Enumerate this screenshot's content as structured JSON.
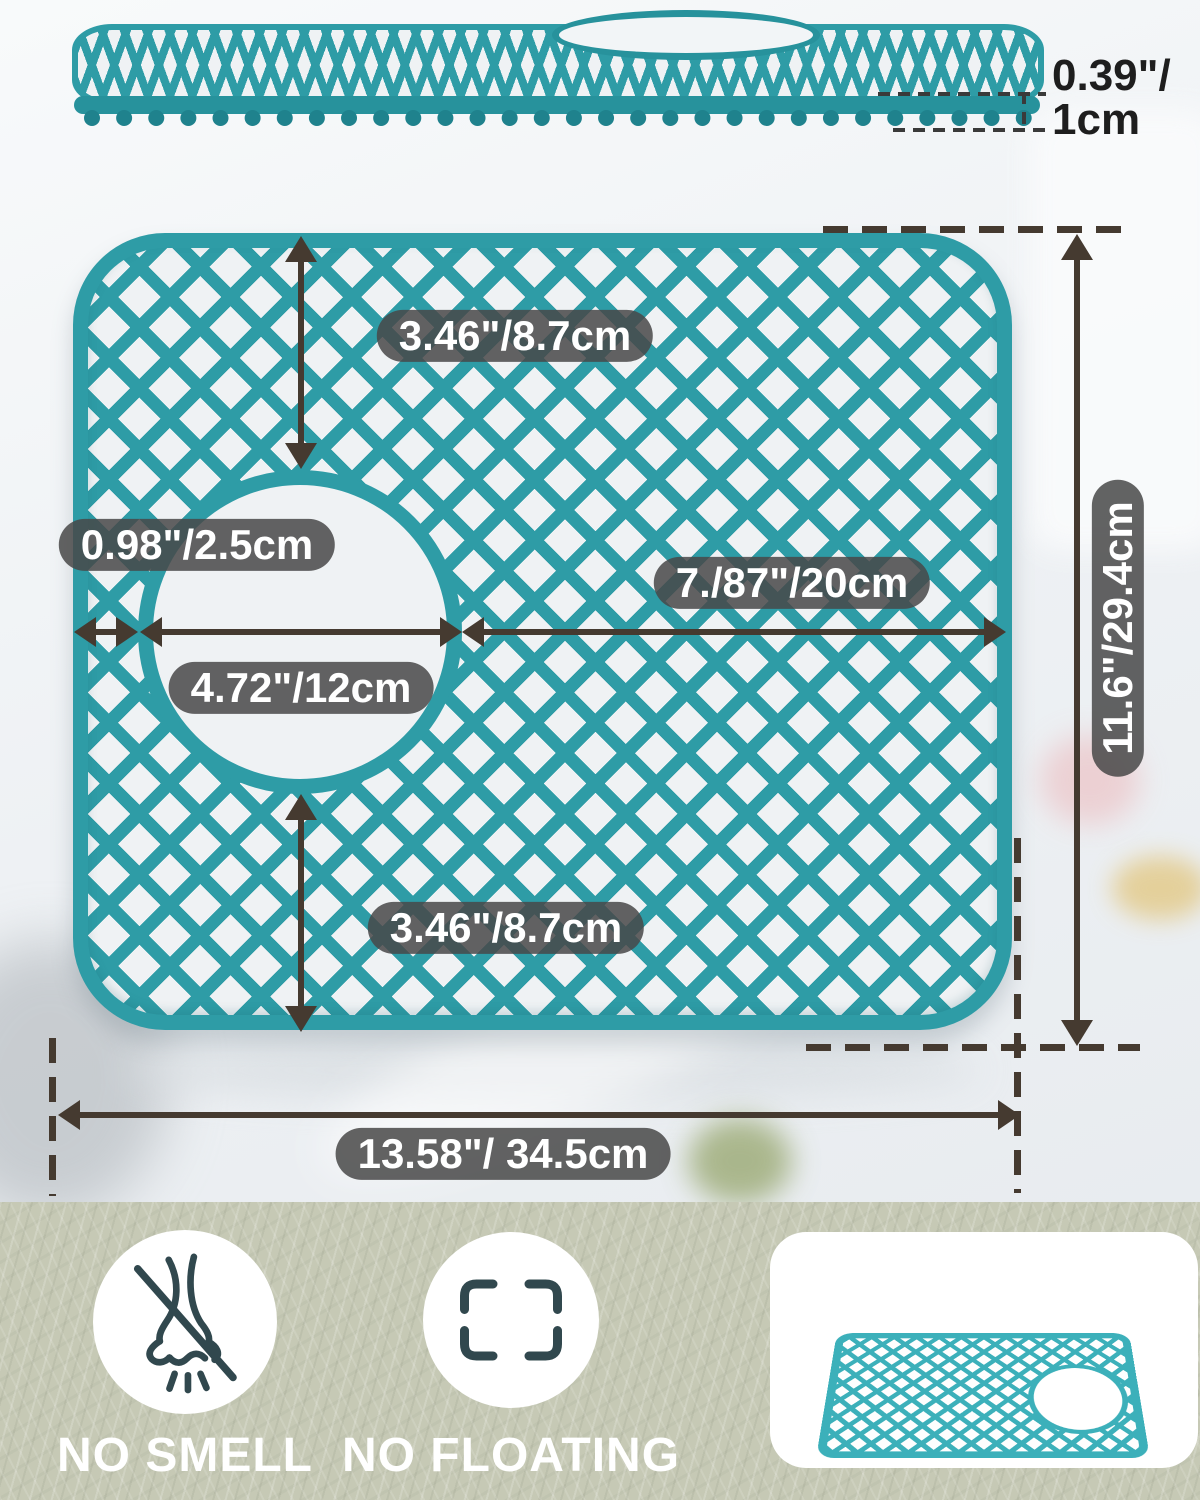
{
  "side_view": {
    "thickness_line1": "0.39\"/",
    "thickness_line2": "1cm"
  },
  "dimensions": {
    "top_gap": "3.46\"/8.7cm",
    "left_edge_gap": "0.98\"/2.5cm",
    "hole_diameter": "4.72\"/12cm",
    "right_span": "7./87\"/20cm",
    "mat_height": "11.6\"/29.4cm",
    "bottom_gap": "3.46\"/8.7cm",
    "mat_width": "13.58\"/ 34.5cm"
  },
  "features": {
    "no_smell": {
      "label": "NO SMELL",
      "icon": "nose-crossed-icon"
    },
    "no_floating": {
      "label": "NO FLOATING",
      "icon": "corner-brackets-icon"
    }
  },
  "colors": {
    "mat_teal": "#2E9CA6",
    "mat_teal_light": "#3CB0BA",
    "arrow_dark": "#453A30",
    "dimension_pill_bg": "#4F4F4F",
    "dimension_pill_text": "#FFFFFF",
    "bottom_background": "#C6C9B5",
    "icon_stroke": "#31484E",
    "feature_text": "#FFFFFF",
    "thickness_text": "#1E1E1E"
  }
}
